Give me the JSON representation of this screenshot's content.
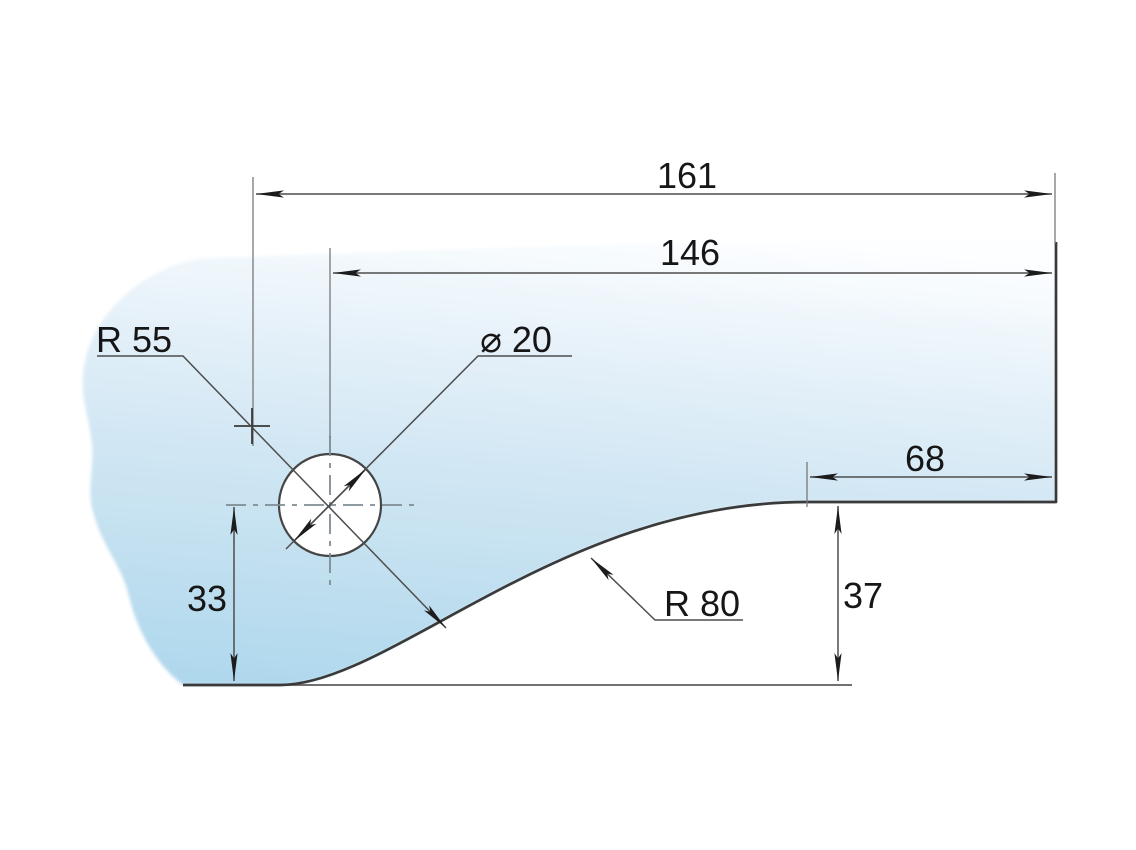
{
  "drawing": {
    "type": "glass-panel-corner-technical-drawing",
    "background_color": "#ffffff",
    "glass": {
      "gradient_top": "#fcfeff",
      "gradient_upper": "#e9f3fa",
      "gradient_mid": "#d3e7f4",
      "gradient_lower": "#c2e0f0",
      "gradient_bottom": "#b0d8ed",
      "edge_color": "#3a3a3a"
    },
    "line_colors": {
      "dimension": "#4d4d4d",
      "extension": "#787878",
      "centerline": "#7f8b93",
      "arrow": "#1c1c1c",
      "text": "#161616"
    },
    "dims": {
      "overall_width": "161",
      "hole_center_to_right": "146",
      "flat_top_length": "68",
      "right_edge_height": "37",
      "hole_center_height": "33",
      "left_radius": "R 55",
      "hole_diameter": "⌀ 20",
      "right_radius": "R 80"
    }
  }
}
